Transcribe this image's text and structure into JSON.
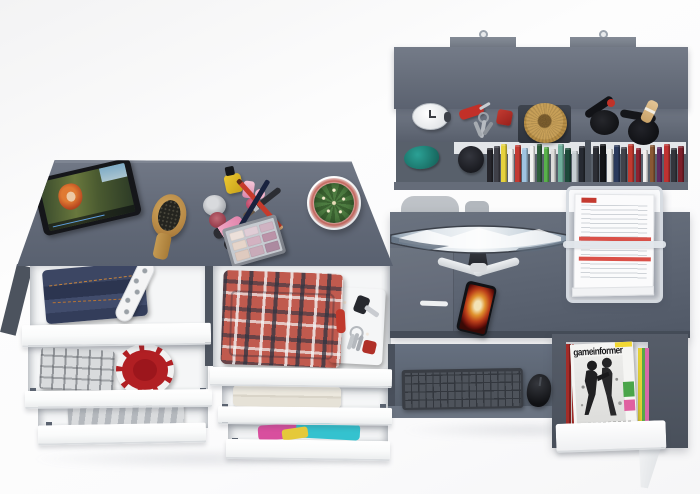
{
  "meta": {
    "description": "3D product render, top view of a gray-and-white teen room furniture set: dresser with open drawers, wall hutch with books, and a computer desk",
    "background_color": "#fbfbfc"
  },
  "palette": {
    "furniture_gray": "#5d6572",
    "furniture_dark": "#4c535f",
    "furniture_light": "#6d7482",
    "drawer_white": "#ffffff",
    "accent_red": "#c0392c",
    "denim_blue": "#333d5a",
    "straw_tan": "#c8a058"
  },
  "dresser": {
    "label": "dresser with open drawers",
    "top_items": {
      "tablet": "tablet playing an animated movie",
      "hairbrush": "wooden hairbrush",
      "makeup_set": "nail polish, perfume, lip gloss, pencils, eyeshadow palette",
      "cactus": "cactus in white pot"
    },
    "eyeshadow_pans": [
      "#ece0da",
      "#e0cdd6",
      "#cfb3c2",
      "#e6d5ca",
      "#d3b2c1",
      "#bb93a8",
      "#dfcabf",
      "#c9abb9",
      "#ac8aa0"
    ],
    "drawers_left": [
      {
        "contents": "folded jeans and polka-dot umbrella"
      },
      {
        "contents": "gray plaid shirt and red patterned hat"
      },
      {
        "contents": "gray striped clothes"
      }
    ],
    "drawers_right": [
      {
        "contents": "red plaid shirts and leather organizer with pocket knife and keys"
      },
      {
        "contents": "folded towel"
      },
      {
        "contents": "colorful clothes"
      }
    ]
  },
  "hutch": {
    "label": "wall-mounted hutch",
    "shelf_items": [
      "alarm clock",
      "swiss army knife",
      "key ring",
      "red keychain box",
      "straw hat on tray",
      "table tennis paddles with ball"
    ],
    "lower_items": [
      "teal cap",
      "black cap"
    ],
    "books_left": [
      {
        "c": "#26262c",
        "h": 34
      },
      {
        "c": "#3f4048",
        "h": 36
      },
      {
        "c": "#e6d23c",
        "h": 38
      },
      {
        "c": "#f0f0ee",
        "h": 33
      },
      {
        "c": "#c23a32",
        "h": 37
      },
      {
        "c": "#9fc3e0",
        "h": 34
      },
      {
        "c": "#f2f2f0",
        "h": 36
      },
      {
        "c": "#2f5e3c",
        "h": 38
      },
      {
        "c": "#58b14b",
        "h": 35
      },
      {
        "c": "#dcdcda",
        "h": 33
      },
      {
        "c": "#6fae9b",
        "h": 38
      },
      {
        "c": "#1e4a3a",
        "h": 34
      },
      {
        "c": "#c6ced2",
        "h": 31
      },
      {
        "c": "#262a32",
        "h": 36
      }
    ],
    "books_right": [
      {
        "c": "#2c2e35",
        "h": 36
      },
      {
        "c": "#141518",
        "h": 38
      },
      {
        "c": "#ececea",
        "h": 33
      },
      {
        "c": "#2b3a5c",
        "h": 37
      },
      {
        "c": "#41434b",
        "h": 35
      },
      {
        "c": "#c13a30",
        "h": 38
      },
      {
        "c": "#8c2230",
        "h": 34
      },
      {
        "c": "#f0eeec",
        "h": 32
      },
      {
        "c": "#8a5834",
        "h": 37
      },
      {
        "c": "#5e2a64",
        "h": 35
      },
      {
        "c": "#bf3231",
        "h": 38
      },
      {
        "c": "#33353c",
        "h": 34
      },
      {
        "c": "#7c1f2a",
        "h": 36
      }
    ]
  },
  "desk": {
    "label": "computer desk",
    "items": {
      "chair": "office chair pushed under desk",
      "monitor": "curved widescreen monitor with snowy mountain wallpaper",
      "phone": "smartphone with flame wallpaper",
      "letter_tray": "acrylic letter tray with documents",
      "keyboard": "wireless keyboard on pull-out tray",
      "mouse": "wireless mouse"
    },
    "magazine": {
      "title": "gameinformer"
    }
  }
}
